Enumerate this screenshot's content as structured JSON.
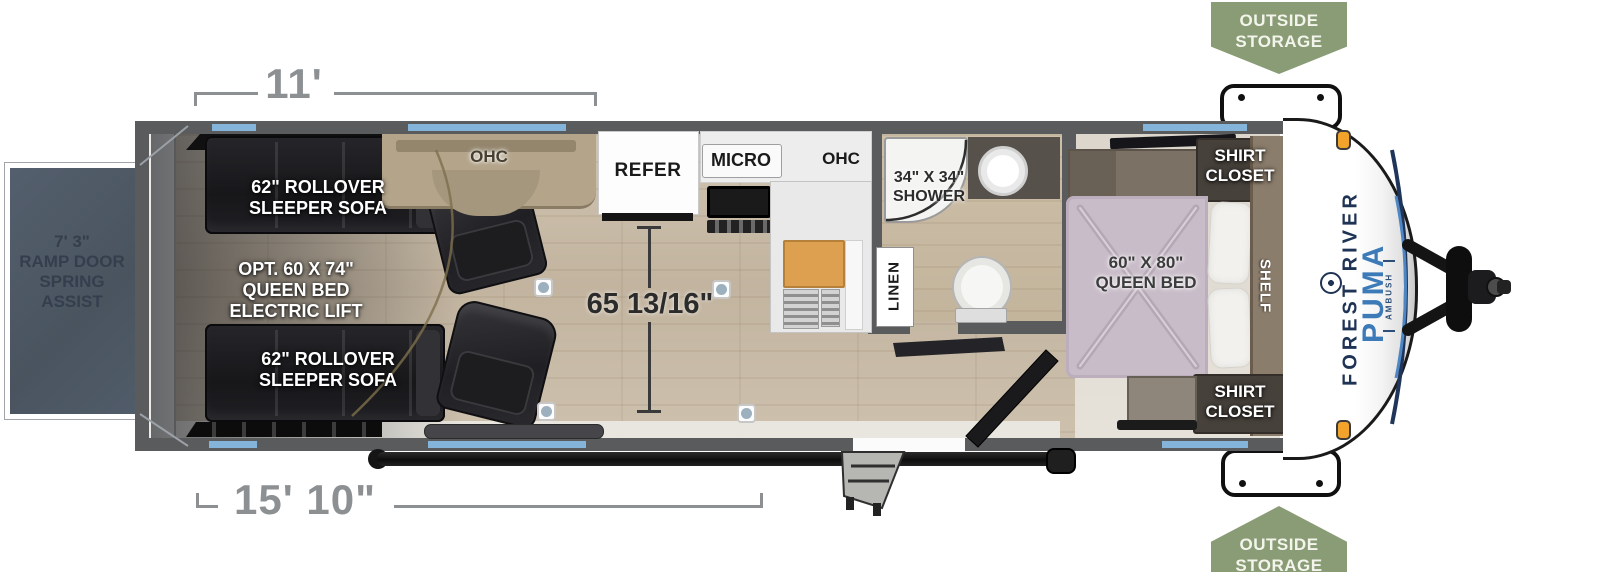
{
  "dimensions": {
    "garage_length": "11'",
    "cargo_length": "15' 10\"",
    "interior_clear_width": "65 13/16\"",
    "ramp_door": [
      "7' 3\"",
      "RAMP DOOR",
      "SPRING",
      "ASSIST"
    ]
  },
  "labels": {
    "sofa_top": [
      "62\" ROLLOVER",
      "SLEEPER SOFA"
    ],
    "sofa_bottom": [
      "62\" ROLLOVER",
      "SLEEPER SOFA"
    ],
    "opt_queen": [
      "OPT. 60 X 74\"",
      "QUEEN BED",
      "ELECTRIC LIFT"
    ],
    "ohc_left": "OHC",
    "refer": "REFER",
    "micro": "MICRO",
    "ohc_right": "OHC",
    "shower": [
      "34\" X 34\"",
      "SHOWER"
    ],
    "linen": "LINEN",
    "queen_bed": [
      "60\" X 80\"",
      "QUEEN BED"
    ],
    "shirt_closet_top": [
      "SHIRT",
      "CLOSET"
    ],
    "shirt_closet_bottom": [
      "SHIRT",
      "CLOSET"
    ],
    "shelf": "SHELF"
  },
  "badges": {
    "outside_storage_top": [
      "OUTSIDE",
      "STORAGE"
    ],
    "outside_storage_bottom": [
      "OUTSIDE",
      "STORAGE"
    ]
  },
  "brand": {
    "manufacturer": "FOREST RIVER",
    "model": "PUMA",
    "series": "AMBUSH"
  },
  "colors": {
    "window_blue": "#85b4da",
    "badge_green": "#8a9c75",
    "wall_gray": "#595b5d",
    "ramp_gray": "#4e5966",
    "dimension_text": "#8d9093",
    "brand_navy": "#1f3354",
    "brand_blue": "#3c7ab8",
    "bed_lavender": "#c8bcc8",
    "floor_tan": "#c6b9a6"
  }
}
